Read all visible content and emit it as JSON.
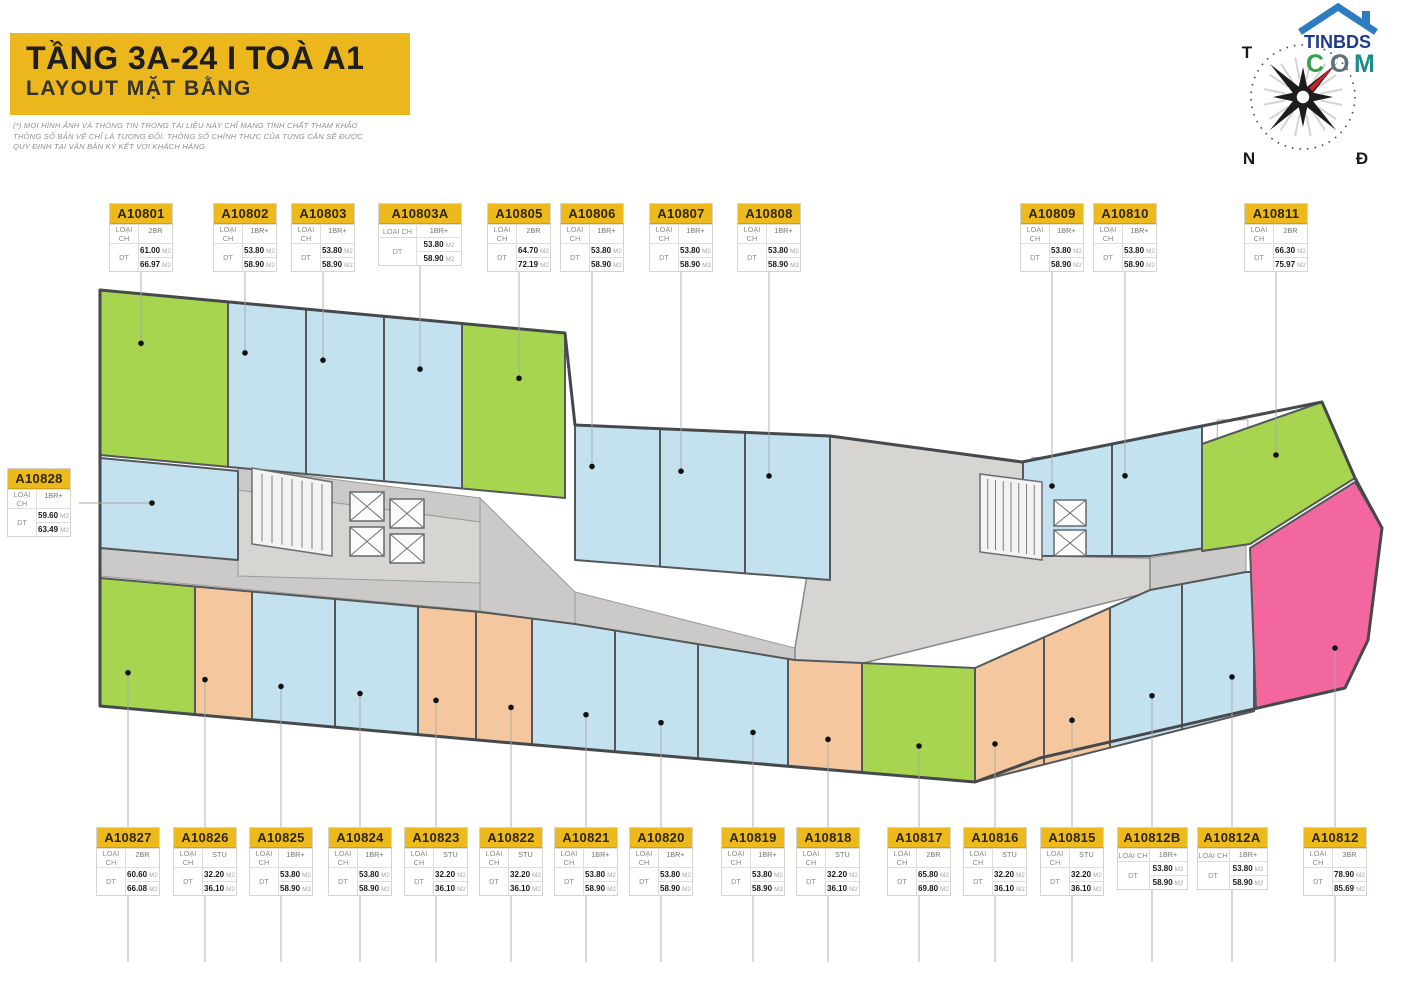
{
  "banner": {
    "title": "TẦNG 3A-24 I TOÀ A1",
    "subtitle": "LAYOUT MẶT BẰNG",
    "bg_color": "#ecb71d"
  },
  "disclaimer": [
    "(*) MỌI HÌNH ẢNH VÀ THÔNG TIN TRONG TÀI LIỆU NÀY CHỈ MANG TÍNH CHẤT THAM KHẢO",
    "THÔNG SỐ BẢN VẼ CHỈ LÀ TƯƠNG ĐỐI. THÔNG SỐ CHÍNH THỨC CỦA TỪNG CĂN SẼ ĐƯỢC",
    "QUY ĐỊNH TẠI VĂN BẢN KÝ KẾT VỚI KHÁCH HÀNG"
  ],
  "compass": {
    "west": "T",
    "south": "N",
    "east": "Đ",
    "needle_color": "#ce2127"
  },
  "logo": {
    "line1": "TINBDS",
    "line1_color": "#1e3a8f",
    "house_color": "#2e7cc0",
    "line2_letters": [
      {
        "ch": "C",
        "color": "#35a24b"
      },
      {
        "ch": "O",
        "color": "#5d6f7e"
      },
      {
        "ch": "M",
        "color": "#1d8a8d"
      }
    ]
  },
  "labels_meta": {
    "type_label": "LOẠI CH",
    "area_label": "DT",
    "area_unit": "M2"
  },
  "type_colors": {
    "STU": "#f4c79e",
    "1BR+": "#c4e1ef",
    "2BR": "#a7d550",
    "3BR": "#f1679e"
  },
  "plan_colors": {
    "wall": "#54585a",
    "corridor": "#cbcac8",
    "core": "#d6d5d2",
    "leader": "#a9a9a9",
    "dot": "#111111"
  },
  "units": [
    {
      "id": "A10801",
      "type": "2BR",
      "areas": [
        "61.00",
        "66.97"
      ]
    },
    {
      "id": "A10802",
      "type": "1BR+",
      "areas": [
        "53.80",
        "58.90"
      ]
    },
    {
      "id": "A10803",
      "type": "1BR+",
      "areas": [
        "53.80",
        "58.90"
      ]
    },
    {
      "id": "A10803A",
      "type": "1BR+",
      "areas": [
        "53.80",
        "58.90"
      ]
    },
    {
      "id": "A10805",
      "type": "2BR",
      "areas": [
        "64.70",
        "72.19"
      ]
    },
    {
      "id": "A10806",
      "type": "1BR+",
      "areas": [
        "53.80",
        "58.90"
      ]
    },
    {
      "id": "A10807",
      "type": "1BR+",
      "areas": [
        "53.80",
        "58.90"
      ]
    },
    {
      "id": "A10808",
      "type": "1BR+",
      "areas": [
        "53.80",
        "58.90"
      ]
    },
    {
      "id": "A10809",
      "type": "1BR+",
      "areas": [
        "53.80",
        "58.90"
      ]
    },
    {
      "id": "A10810",
      "type": "1BR+",
      "areas": [
        "53.80",
        "58.90"
      ]
    },
    {
      "id": "A10811",
      "type": "2BR",
      "areas": [
        "66.30",
        "75.97"
      ]
    },
    {
      "id": "A10828",
      "type": "1BR+",
      "areas": [
        "59.60",
        "63.49"
      ]
    },
    {
      "id": "A10827",
      "type": "2BR",
      "areas": [
        "60.60",
        "66.08"
      ]
    },
    {
      "id": "A10826",
      "type": "STU",
      "areas": [
        "32.20",
        "36.10"
      ]
    },
    {
      "id": "A10825",
      "type": "1BR+",
      "areas": [
        "53.80",
        "58.90"
      ]
    },
    {
      "id": "A10824",
      "type": "1BR+",
      "areas": [
        "53.80",
        "58.90"
      ]
    },
    {
      "id": "A10823",
      "type": "STU",
      "areas": [
        "32.20",
        "36.10"
      ]
    },
    {
      "id": "A10822",
      "type": "STU",
      "areas": [
        "32.20",
        "36.10"
      ]
    },
    {
      "id": "A10821",
      "type": "1BR+",
      "areas": [
        "53.80",
        "58.90"
      ]
    },
    {
      "id": "A10820",
      "type": "1BR+",
      "areas": [
        "53.80",
        "58.90"
      ]
    },
    {
      "id": "A10819",
      "type": "1BR+",
      "areas": [
        "53.80",
        "58.90"
      ]
    },
    {
      "id": "A10818",
      "type": "STU",
      "areas": [
        "32.20",
        "36.10"
      ]
    },
    {
      "id": "A10817",
      "type": "2BR",
      "areas": [
        "65.80",
        "69.80"
      ]
    },
    {
      "id": "A10816",
      "type": "STU",
      "areas": [
        "32.20",
        "36.10"
      ]
    },
    {
      "id": "A10815",
      "type": "STU",
      "areas": [
        "32.20",
        "36.10"
      ]
    },
    {
      "id": "A10812B",
      "type": "1BR+",
      "areas": [
        "53.80",
        "58.90"
      ]
    },
    {
      "id": "A10812A",
      "type": "1BR+",
      "areas": [
        "53.80",
        "58.90"
      ]
    },
    {
      "id": "A10812",
      "type": "3BR",
      "areas": [
        "78.90",
        "85.69"
      ]
    }
  ]
}
